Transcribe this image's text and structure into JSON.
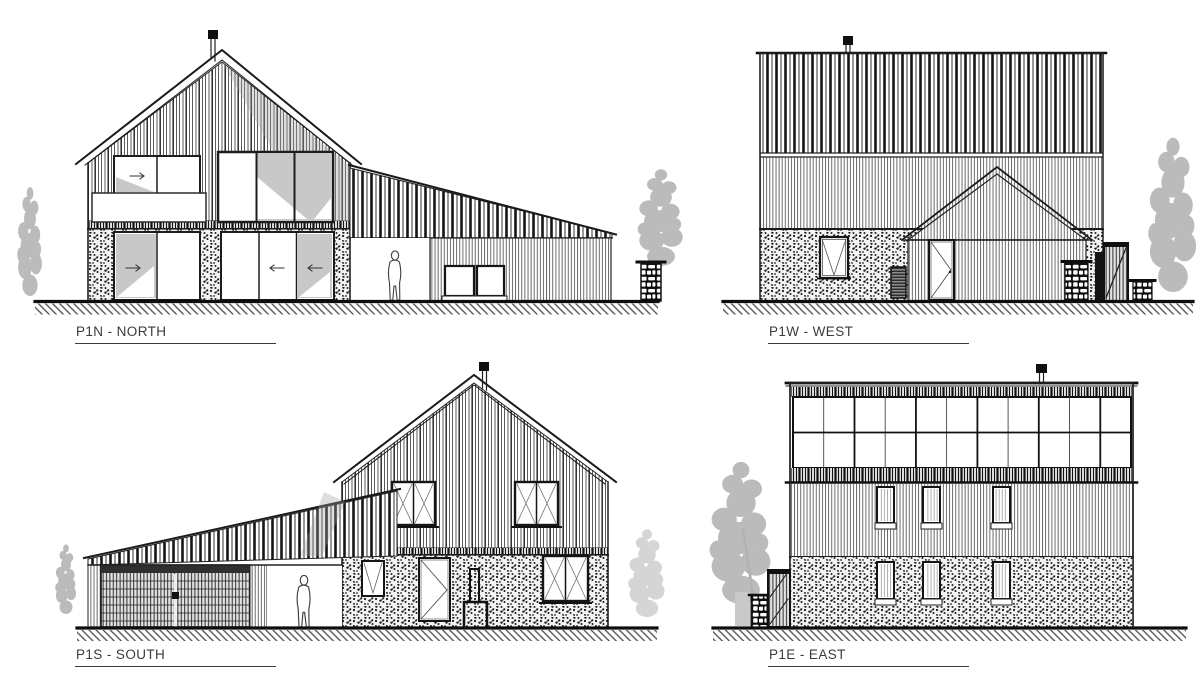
{
  "sheet_title": "House elevations drawing",
  "elevations": [
    {
      "id": "north",
      "label": "P1N - NORTH"
    },
    {
      "id": "west",
      "label": "P1W - WEST"
    },
    {
      "id": "south",
      "label": "P1S - SOUTH"
    },
    {
      "id": "east",
      "label": "P1E - EAST"
    }
  ],
  "colors": {
    "background": "#ffffff",
    "ink": "#222222",
    "label_text": "#3b3b3b",
    "glass_shade": "#c8c8c8",
    "shadow": "#a0a0a0",
    "tree_foliage": "#b4b4b4"
  }
}
